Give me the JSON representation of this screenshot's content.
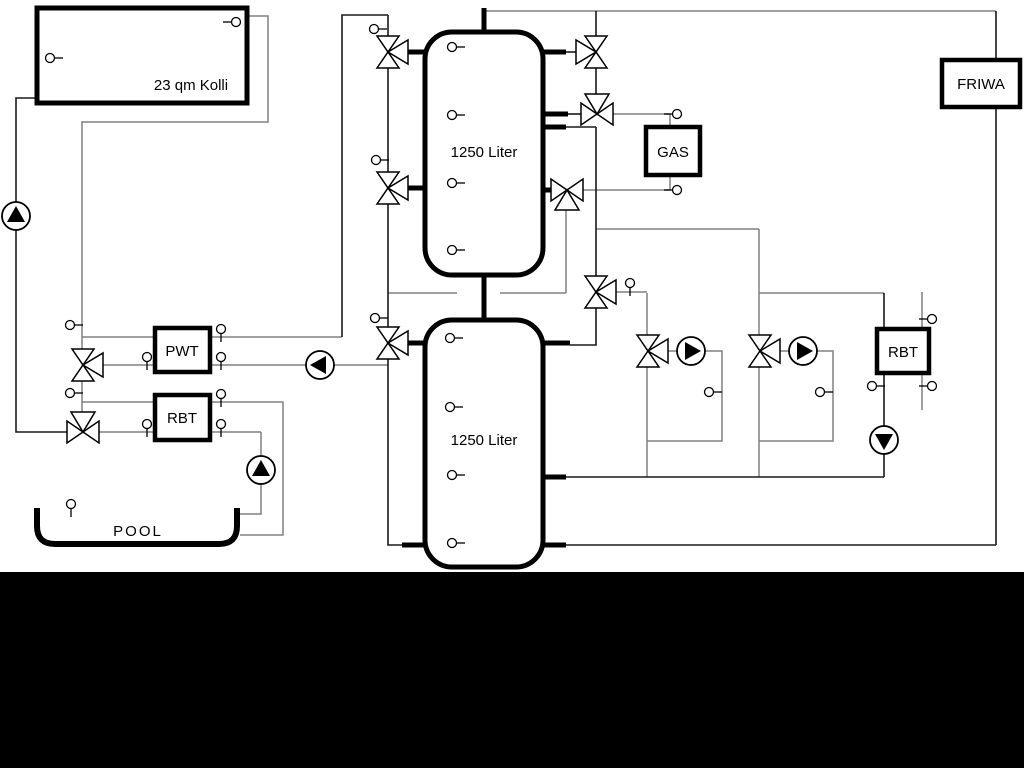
{
  "diagram": {
    "collector": {
      "label": "23 qm Kolli"
    },
    "tank1": {
      "label": "1250 Liter"
    },
    "tank2": {
      "label": "1250 Liter"
    },
    "pwt": {
      "label": "PWT"
    },
    "rbt_left": {
      "label": "RBT"
    },
    "gas": {
      "label": "GAS"
    },
    "friwa": {
      "label": "FRIWA"
    },
    "rbt_right": {
      "label": "RBT"
    },
    "pool": {
      "label": "POOL"
    },
    "colors": {
      "pipe_gray": "#808080",
      "pipe_black": "#1a1a1a",
      "component_black": "#000000",
      "background": "#ffffff",
      "bottom_band": "#000000"
    }
  }
}
